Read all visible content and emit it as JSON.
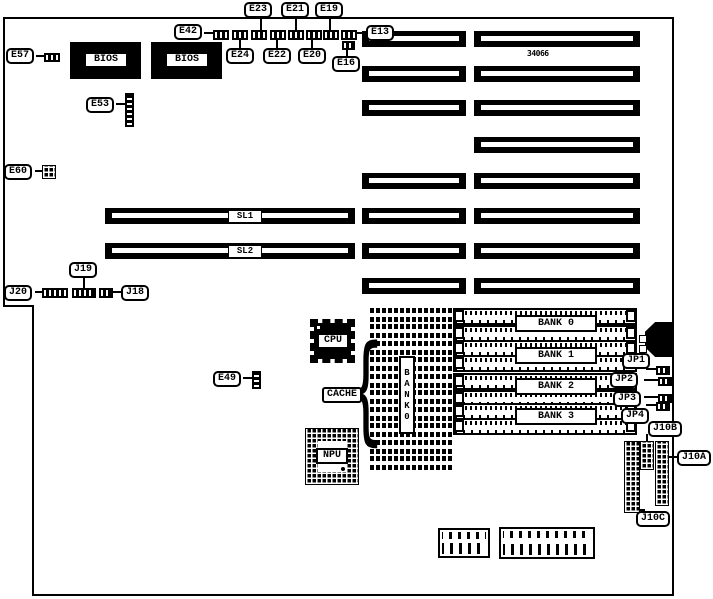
{
  "diagram": {
    "type": "motherboard-layout",
    "colors": {
      "ink": "#000000",
      "paper": "#ffffff"
    },
    "chip_marking": "34066",
    "cache_brace_glyph": "{",
    "labels": {
      "e57": "E57",
      "e42": "E42",
      "e23": "E23",
      "e21": "E21",
      "e19": "E19",
      "e24": "E24",
      "e22": "E22",
      "e20": "E20",
      "e13": "E13",
      "e16": "E16",
      "e53": "E53",
      "e60": "E60",
      "j20": "J20",
      "j19": "J19",
      "j18": "J18",
      "e49": "E49",
      "cache": "CACHE",
      "jp1": "JP1",
      "jp2": "JP2",
      "jp3": "JP3",
      "jp4": "JP4",
      "j10a": "J10A",
      "j10b": "J10B",
      "j10c": "J10C"
    },
    "chips": {
      "bios1": "BIOS",
      "bios2": "BIOS",
      "cpu": "CPU",
      "npu": "NPU",
      "vertical_bank": "BANK0"
    },
    "slots": {
      "sl1": "SL1",
      "sl2": "SL2"
    },
    "memory_banks": [
      {
        "label": "BANK 0"
      },
      {
        "label": "BANK 1"
      },
      {
        "label": "BANK 2"
      },
      {
        "label": "BANK 3"
      }
    ]
  }
}
